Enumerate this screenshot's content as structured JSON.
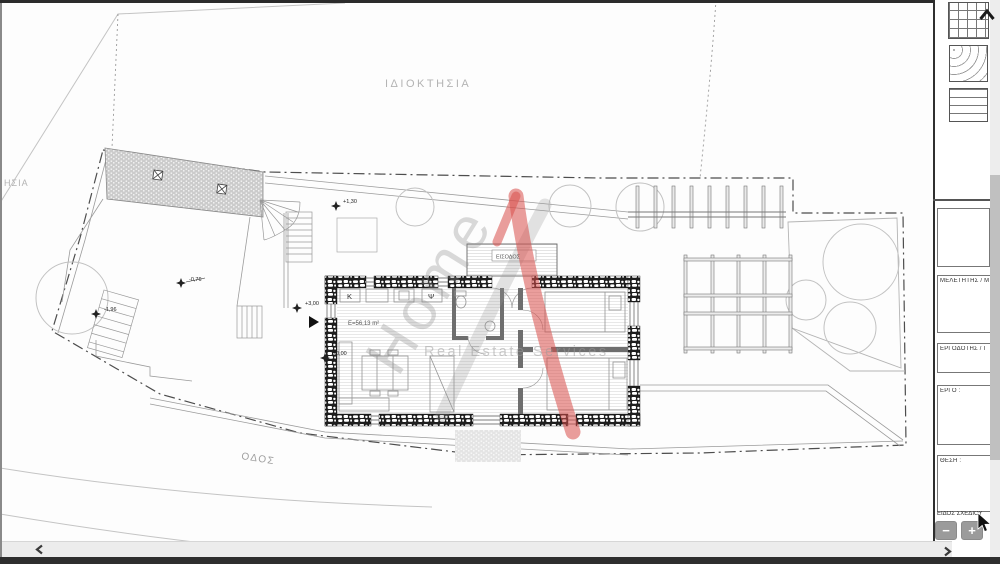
{
  "plan": {
    "labels": {
      "property_top": "ΙΔΙΟΚΤΗΣΙΑ",
      "property_left": "ΗΣΙΑ",
      "road": "ΟΔΟΣ",
      "entrance": "ΕΙΣΟΔΟΣ",
      "area": "Ε=56,13 m²",
      "kitchen": "Κ",
      "laundry": "Ψ"
    },
    "levels": {
      "deck": "+1,30",
      "terrace": "-0,76",
      "roof": "+3,00",
      "ground": "±0,00",
      "lower": "-1,96"
    },
    "watermark": {
      "word": "Home",
      "tagline": "Real Estate Services",
      "accent_color": "#d94f4a"
    }
  },
  "title_block": {
    "fields": [
      {
        "label": ""
      },
      {
        "label": "ΜΕΛΕΤΗΤΗΣ / Μ"
      },
      {
        "label": "ΕΡΓΟΔΟΤΗΣ / Ι"
      },
      {
        "label": "ΕΡΓΟ :"
      },
      {
        "label": "ΘΕΣΗ :"
      }
    ],
    "drawing_type": "ΕΙΔΟΣ ΣΧΕΔΙΟΥ",
    "zoom_out_label": "−",
    "zoom_in_label": "+"
  }
}
